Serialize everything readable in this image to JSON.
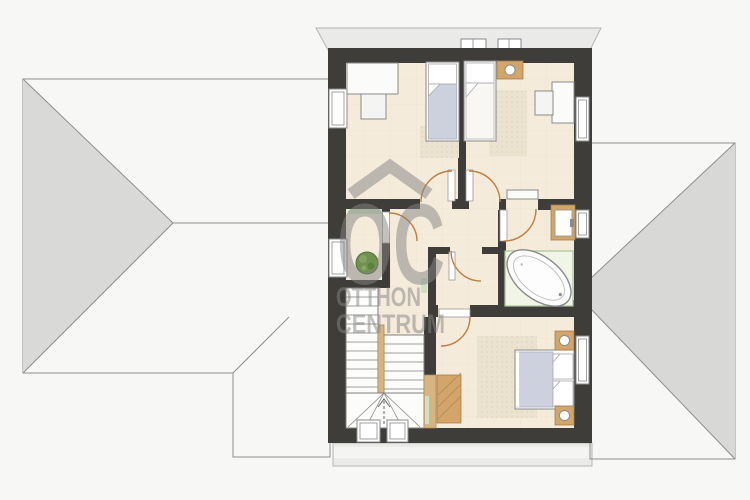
{
  "watermark": {
    "logo": "OC",
    "line1": "OTTHON",
    "line2": "CENTRUM",
    "icon": "house-roof-chevron"
  },
  "palette": {
    "bg": "#f7f7f5",
    "wall": "#3f3d3a",
    "floor": "#f4ebdb",
    "tile": "#cdccca",
    "smooth": "#d9d9d7",
    "eave": "#eaeae8",
    "wood": "#d2a56b",
    "green": "#cfe0c3",
    "arc": "#c07e3e",
    "mattress": "#ccd1dd",
    "watermark": "#858583"
  }
}
